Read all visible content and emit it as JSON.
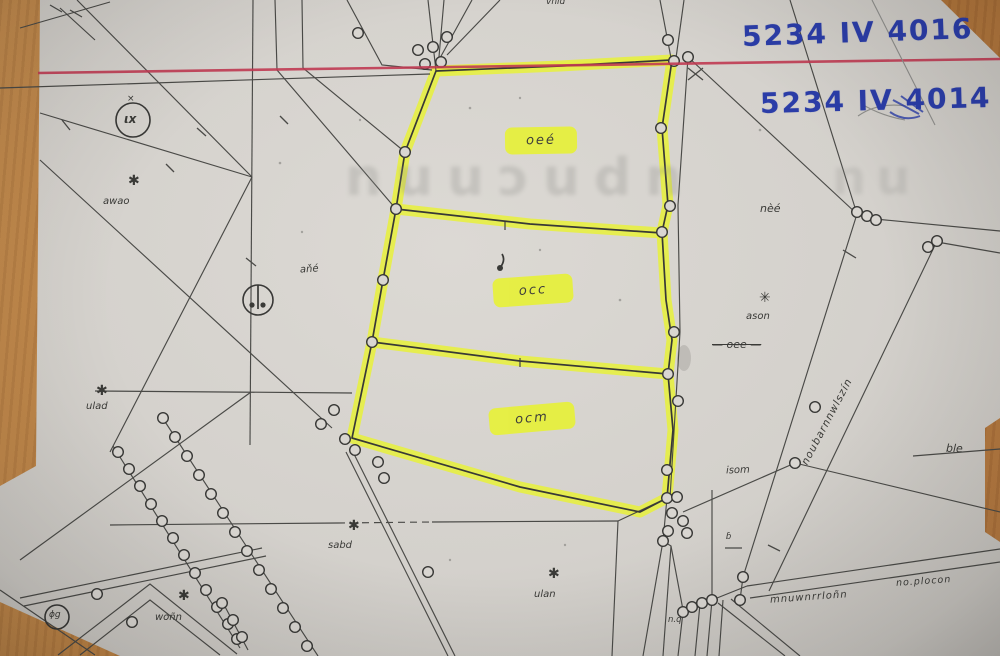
{
  "colors": {
    "paper": "#d6d3ce",
    "wood": "#b5793d",
    "highlight": "#e7f13a",
    "red_line": "#c03a52",
    "blue_ink": "#2b3da8",
    "map_line": "#4a4a47",
    "boundary": "#383836"
  },
  "sheet_labels": {
    "top": "5234 IV 4016",
    "bottom": "5234 IV 4014"
  },
  "parcels": [
    {
      "label": "oeé"
    },
    {
      "label": "occ"
    },
    {
      "label": "ocm"
    }
  ],
  "watermarks": {
    "left": "nuuɔudn",
    "right": "nu"
  },
  "stars": [
    {
      "symbol": "✱",
      "text": "awao"
    },
    {
      "symbol": "✱",
      "text": "ulad"
    },
    {
      "symbol": "✱",
      "text": "sabd"
    },
    {
      "symbol": "✱",
      "text": "ulan"
    },
    {
      "symbol": "✱",
      "text": "woñn"
    },
    {
      "symbol": "✳",
      "text": "ason"
    }
  ],
  "small_labels": {
    "circle_left": "ιx",
    "circle_left_tick": "×",
    "circle_bl": "ɸg",
    "near_circle_mid": "aňé",
    "right_upper": "nèé",
    "right_crossed": "— oee —",
    "right_lower": "isom",
    "right_edge": "ble",
    "bottom_cluster": "n.q",
    "bottom_small": "ɓ",
    "top_cut": "vnıd",
    "road_main": "mnuwnrrloñn",
    "road_far": "no.plocon",
    "corridor": "noubarnnwlszín"
  }
}
